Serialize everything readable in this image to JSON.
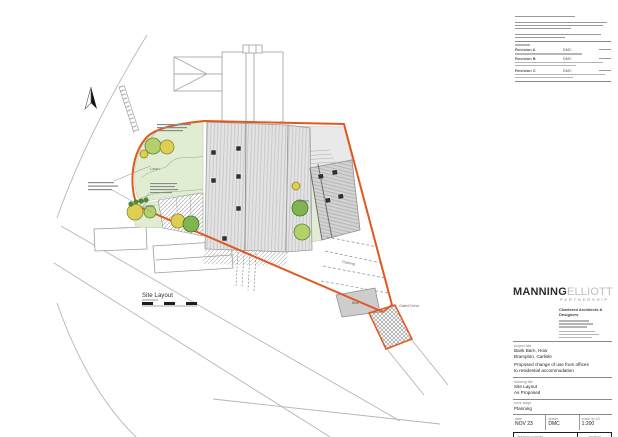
{
  "plan": {
    "title": "Site Layout",
    "labels": {
      "lawn": "Lawn",
      "garden_left": "Garden",
      "garden_right": "Garden",
      "parking": "Parking",
      "bins": "Bins",
      "gated_drive": "Gated Drive"
    }
  },
  "title_block": {
    "logo": {
      "name_bold": "MANNING",
      "name_light": "ELLIOTT",
      "subtitle": "PARTNERSHIP",
      "tagline_line1": "Chartered Architects &",
      "tagline_line2": "Designers"
    },
    "revisions": [
      {
        "label": "Revision A",
        "by": "DMC"
      },
      {
        "label": "Revision B",
        "by": "DMC"
      },
      {
        "label": "Revision C",
        "by": "DMC"
      }
    ],
    "project": {
      "label": "project title",
      "line1": "Bank Barn, How",
      "line2": "Brampton, Carlisle",
      "line3": "Proposed change of use from offices",
      "line4": "to residential accommodation"
    },
    "drawing": {
      "label": "drawing title",
      "line1": "Site Layout",
      "line2": "As Proposed"
    },
    "stage": {
      "label": "work stage",
      "value": "Planning"
    },
    "meta": {
      "date_label": "date",
      "date": "NOV 23",
      "drawn_label": "drawn",
      "drawn": "DMC",
      "scale_label": "scale @ A3",
      "scale": "1:200"
    },
    "number": {
      "label": "drawing number",
      "value": "2327-PL-210",
      "rev_label": "revision",
      "rev": "C"
    }
  },
  "colors": {
    "boundary_orange": "#e2571f",
    "lawn_green": "#e0edd3",
    "tree_green": "#b5d06b",
    "tree_yellow": "#ddcf52",
    "roof_grey": "#e4e4e4"
  }
}
